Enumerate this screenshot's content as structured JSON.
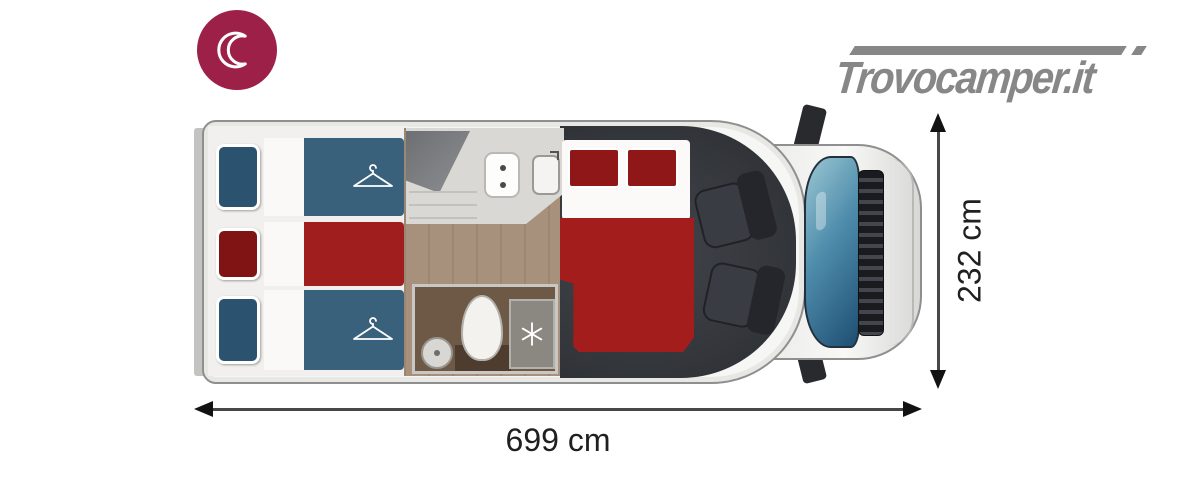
{
  "header": {
    "night_badge": {
      "icon": "moon-icon",
      "background": "#9d2048"
    },
    "logo": {
      "text": "Trovocamper.it",
      "color": "#878787"
    }
  },
  "dimensions": {
    "length_label": "699 cm",
    "width_label": "232 cm"
  },
  "floorplan": {
    "colors": {
      "bed_blue": "#3a617c",
      "bed_red": "#a11e1e",
      "pillow_blue": "#2b5370",
      "pillow_red": "#801313",
      "double_bed_red": "#a31d1d",
      "double_bed_pillow": "#8f1717",
      "wood_floor": "#a8917c",
      "bathroom_floor": "#6e5947",
      "cab_interior": "#33363b",
      "body": "#f6f6f4"
    },
    "zones": {
      "rear_bunk_beds": {
        "count": 3,
        "order": [
          "blue",
          "red",
          "blue"
        ],
        "wardrobe_hangers": 2
      },
      "kitchen": {
        "stove_burners": 2,
        "has_sink": true
      },
      "bathroom": {
        "has_washbasin": true,
        "has_toilet": true,
        "has_shower": true
      },
      "double_bed": {
        "pillows": 2
      },
      "cab": {
        "swivel_seats": 2
      }
    }
  }
}
